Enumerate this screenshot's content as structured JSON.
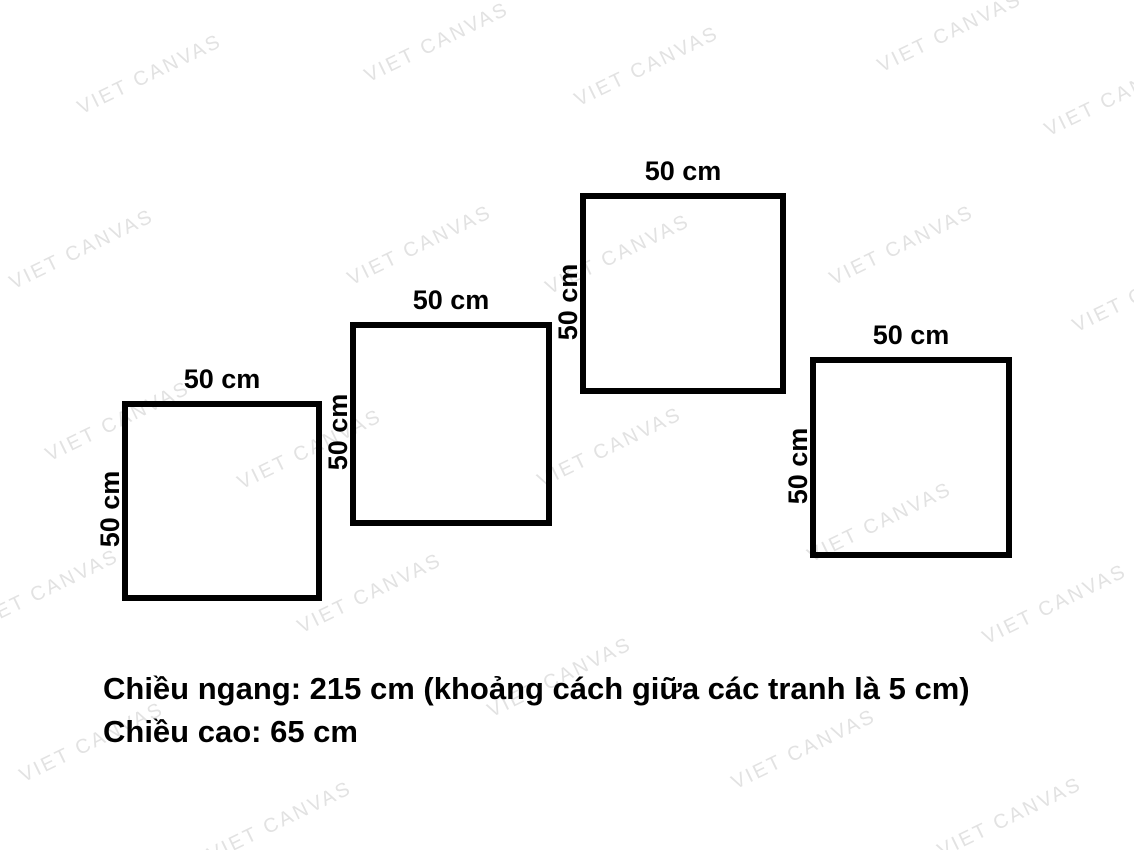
{
  "page": {
    "background": "#ffffff",
    "text_color": "#000000",
    "frame_border_color": "#000000"
  },
  "watermark": {
    "text": "VIET CANVAS",
    "color": "#e2e2e2",
    "rotation_deg": -26,
    "positions": [
      {
        "x": 150,
        "y": 75
      },
      {
        "x": 437,
        "y": 43
      },
      {
        "x": 647,
        "y": 67
      },
      {
        "x": 950,
        "y": 33
      },
      {
        "x": 1117,
        "y": 97
      },
      {
        "x": 82,
        "y": 250
      },
      {
        "x": 420,
        "y": 246
      },
      {
        "x": 618,
        "y": 255
      },
      {
        "x": 902,
        "y": 246
      },
      {
        "x": 1145,
        "y": 293
      },
      {
        "x": 118,
        "y": 422
      },
      {
        "x": 310,
        "y": 450
      },
      {
        "x": 610,
        "y": 448
      },
      {
        "x": 880,
        "y": 523
      },
      {
        "x": 47,
        "y": 590
      },
      {
        "x": 370,
        "y": 594
      },
      {
        "x": 560,
        "y": 678
      },
      {
        "x": 1055,
        "y": 605
      },
      {
        "x": 92,
        "y": 743
      },
      {
        "x": 280,
        "y": 822
      },
      {
        "x": 804,
        "y": 750
      },
      {
        "x": 1010,
        "y": 818
      }
    ]
  },
  "frames": [
    {
      "top_label": "50 cm",
      "side_label": "50 cm",
      "x": 122,
      "y": 401,
      "w": 200,
      "h": 200
    },
    {
      "top_label": "50 cm",
      "side_label": "50 cm",
      "x": 350,
      "y": 322,
      "w": 202,
      "h": 204
    },
    {
      "top_label": "50 cm",
      "side_label": "50 cm",
      "x": 580,
      "y": 193,
      "w": 206,
      "h": 201
    },
    {
      "top_label": "50 cm",
      "side_label": "50 cm",
      "x": 810,
      "y": 357,
      "w": 202,
      "h": 201
    }
  ],
  "notes": {
    "line1": "Chiều ngang: 215 cm (khoảng cách giữa các tranh là 5 cm)",
    "line2": "Chiều cao: 65 cm"
  }
}
